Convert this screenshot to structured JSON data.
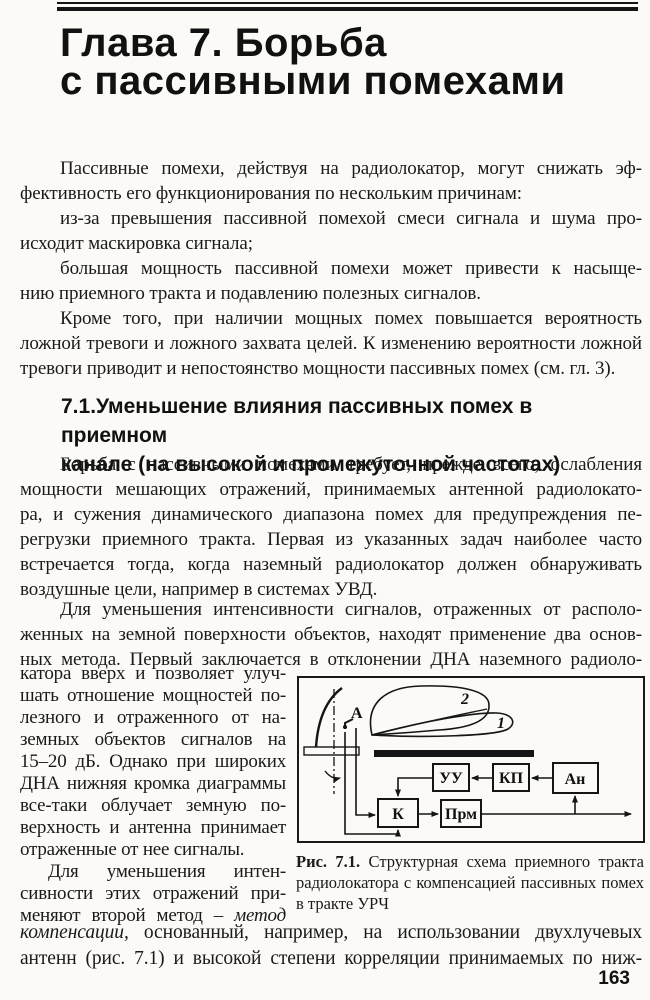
{
  "title": {
    "line1": "Глава 7. Борьба",
    "line2": "с пассивными помехами"
  },
  "intro": {
    "lines": [
      "Пассивные помехи, действуя на радиолокатор, могут снижать эф-",
      "фективность его функционирования по нескольким причинам:",
      "из-за превышения пассивной помехой смеси сигнала и шума про-",
      "исходит маскировка сигнала;",
      "большая мощность пассивной помехи может привести к насыще-",
      "нию приемного тракта и подавлению полезных сигналов.",
      "Кроме того, при наличии мощных помех повышается вероятность",
      "ложной тревоги и ложного захвата целей. К изменению вероятности ложной",
      "тревоги приводит и непостоянство мощности пассивных помех (см. гл. 3)."
    ]
  },
  "section": {
    "line1": "7.1.Уменьшение влияния пассивных помех в приемном",
    "line2": "канале (на высокой и промежуточной частотах)"
  },
  "body1": {
    "lines": [
      "Борьба с пассивными помехами требует, прежде всего, ослабления",
      "мощности мешающих отражений, принимаемых антенной радиолокато-",
      "ра, и сужения динамического диапазона помех для предупреждения пе-",
      "регрузки приемного тракта. Первая из указанных задач наиболее часто",
      "встречается тогда, когда наземный радиолокатор должен обнаруживать",
      "воздушные цели, например в системах УВД."
    ]
  },
  "body2": {
    "lines": [
      "Для уменьшения интенсивности сигналов, отраженных от располо-",
      "женных на земной поверхности объектов, находят применение два основ-",
      "ных метода. Первый заключается в отклонении ДНА наземного радиоло-"
    ]
  },
  "column": {
    "lines": [
      "катора вверх и позволяет улуч-",
      "шать отношение мощностей по-",
      "лезного и отраженного от на-",
      "земных объектов сигналов на",
      "15–20 дБ. Однако при широких",
      "ДНА нижняя кромка диаграммы",
      "все-таки облучает земную по-",
      "верхность и антенна принимает",
      "отраженные от нее сигналы.",
      "Для уменьшения интен-",
      "сивности этих отражений при-"
    ],
    "last_pre": "меняют второй метод – ",
    "last_italic": "метод"
  },
  "figure": {
    "labels": {
      "antenna": "А",
      "beam_upper": "2",
      "beam_lower": "1",
      "uu": "УУ",
      "kp": "КП",
      "an": "Ан",
      "k": "К",
      "prm": "Прм"
    },
    "caption": {
      "bold": "Рис. 7.1.",
      "line1_rest": " Структурная схема приемного тракта",
      "line2": "радиолокатора с компенсацией пассивных помех",
      "line3": "в тракте УРЧ"
    }
  },
  "bottom": {
    "line1_italic": "компенсации,",
    "line1_rest": " основанный, например, на использовании двухлучевых",
    "line2": "антенн (рис. 7.1) и высокой степени корреляции принимаемых по ниж-"
  },
  "footer": {
    "page_number": "163"
  },
  "colors": {
    "ink": "#1a1a1a",
    "paper": "#fbfaf6"
  }
}
